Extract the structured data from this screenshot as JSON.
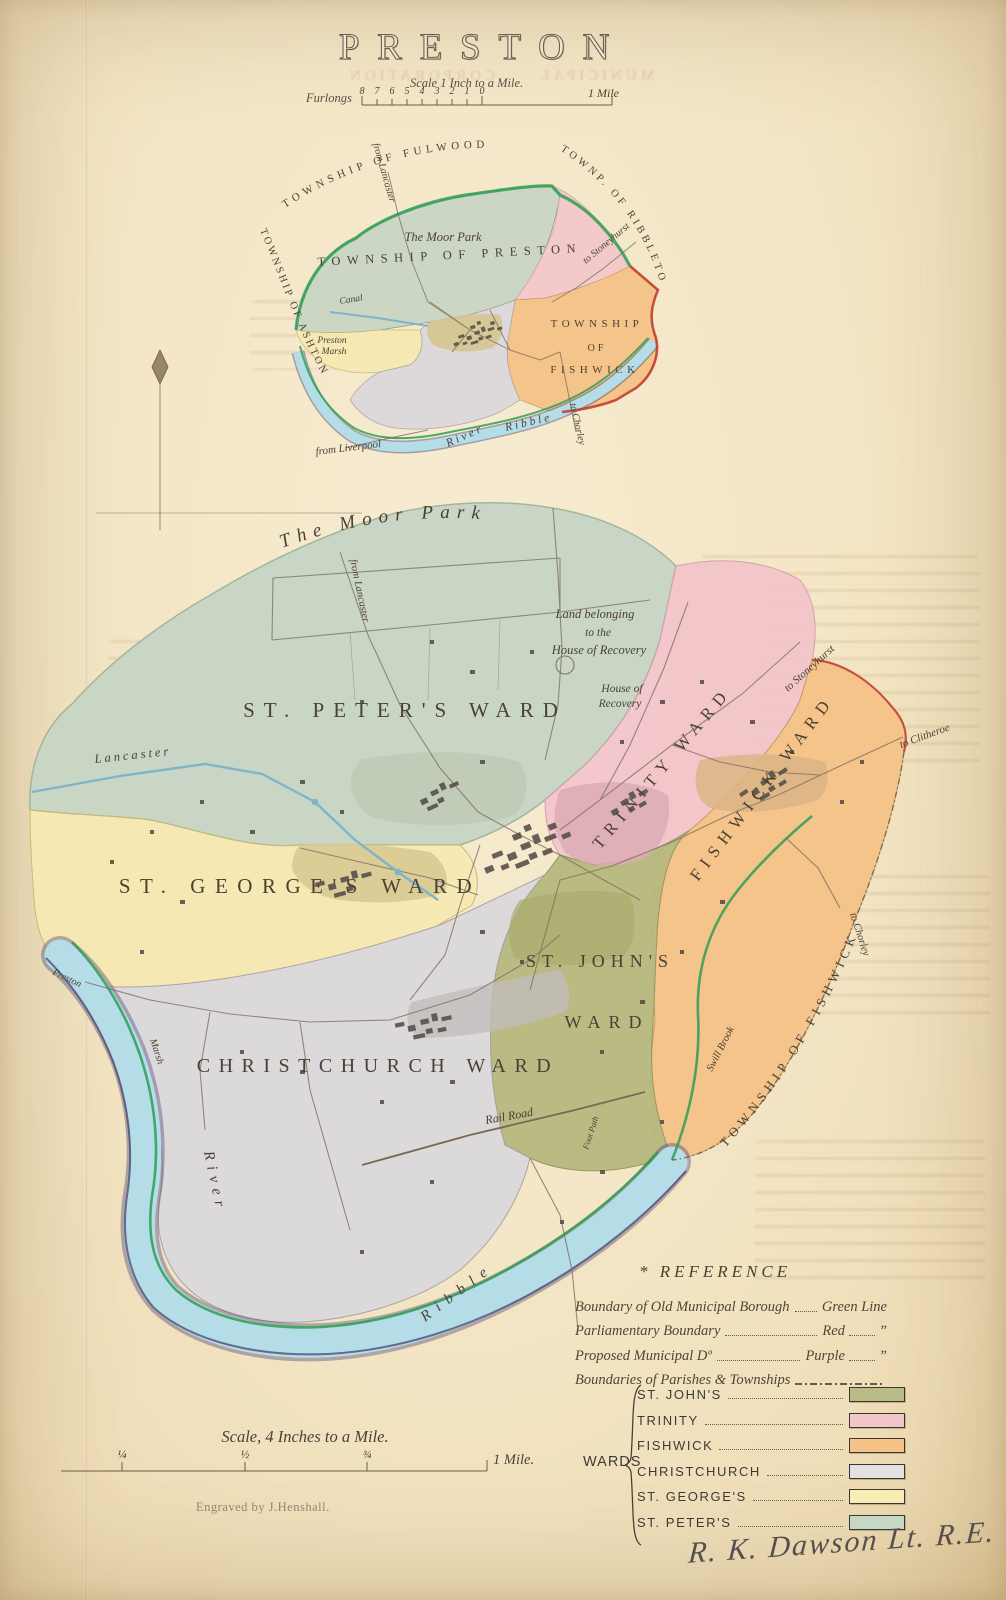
{
  "page": {
    "title": "PRESTON",
    "engraver": "Engraved by J.Henshall.",
    "signature": "R. K. Dawson Lt. R.E.",
    "ghost_title": "MUNICIPAL CORPORATION"
  },
  "scale_top": {
    "caption": "Scale 1 Inch to a Mile.",
    "unit": "Furlongs",
    "ticks": [
      "8",
      "7",
      "6",
      "5",
      "4",
      "3",
      "2",
      "1",
      "0"
    ],
    "end": "1 Mile"
  },
  "scale_bottom": {
    "caption": "Scale, 4 Inches to a Mile.",
    "ticks": [
      "¼",
      "½",
      "¾"
    ],
    "end": "1 Mile."
  },
  "inset": {
    "fulwood": "TOWNSHIP OF FULWOOD",
    "ribbleton": "TOWNP. OF RIBBLETON",
    "ashton": "TOWNSHIP OF ASHTON",
    "preston": "TOWNSHIP OF PRESTON",
    "moor_park": "The Moor Park",
    "canal": "Canal",
    "marsh_1": "Preston",
    "marsh_2": "Marsh",
    "fishwick_1": "TOWNSHIP",
    "fishwick_2": "OF",
    "fishwick_3": "FISHWICK",
    "river_1": "River",
    "river_2": "Ribble",
    "from_lancaster": "from Lancaster",
    "from_liverpool": "from Liverpool",
    "to_stoneyhurst": "to Stoneyhurst",
    "to_chorley": "to Chorley"
  },
  "main": {
    "moor_park": "The Moor Park",
    "from_lancaster": "from Lancaster",
    "land_1": "Land belonging",
    "land_2": "to the",
    "land_3": "House of Recovery",
    "house_1": "House of",
    "house_2": "Recovery",
    "st_peters": "ST. PETER'S WARD",
    "trinity": "TRINITY WARD",
    "fishwick": "FISHWICK WARD",
    "st_georges": "ST. GEORGE'S WARD",
    "st_johns_1": "ST. JOHN'S",
    "st_johns_2": "WARD",
    "christchurch": "CHRISTCHURCH WARD",
    "township_fishwick": "TOWNSHIP OF FISHWICK",
    "lancaster": "Lancaster",
    "to_stoneyhurst": "to Stoneyhurst",
    "to_clitheroe": "to Clitheroe",
    "to_chorley": "to Chorley",
    "swill_brook": "Swill Brook",
    "rail_road": "Rail Road",
    "foot_path": "Foot Path",
    "river": "River",
    "ribble": "Ribble",
    "preston_road": "Preston",
    "marsh": "Marsh"
  },
  "reference": {
    "star": "*",
    "title": "REFERENCE",
    "rows": [
      {
        "label": "Boundary of Old Municipal Borough",
        "value": "Green Line",
        "ditto": ""
      },
      {
        "label": "Parliamentary Boundary",
        "value": "Red",
        "ditto": "”"
      },
      {
        "label": "Proposed Municipal Dº",
        "value": "Purple",
        "ditto": "”"
      },
      {
        "label": "Boundaries of Parishes & Townships",
        "value": "",
        "ditto": ""
      }
    ],
    "wards_label": "WARDS",
    "wards": [
      {
        "name": "ST. JOHN'S",
        "color": "#b9bc85"
      },
      {
        "name": "TRINITY",
        "color": "#f1c5ca"
      },
      {
        "name": "FISHWICK",
        "color": "#f6c287"
      },
      {
        "name": "CHRISTCHURCH",
        "color": "#e4e1e3"
      },
      {
        "name": "ST. GEORGE'S",
        "color": "#f9ecb4"
      },
      {
        "name": "ST. PETER'S",
        "color": "#c6d7c5"
      }
    ]
  },
  "colors": {
    "st_peters": "#c9d6c5",
    "trinity": "#f3c6cb",
    "fishwick": "#f5c388",
    "st_georges": "#f7e9b2",
    "st_johns": "#b7b97f",
    "christchurch": "#dcd9dc",
    "river": "#b5dde8",
    "green_line": "#2f9e56",
    "red_line": "#c0392b",
    "purple_line": "#3f3a69"
  }
}
